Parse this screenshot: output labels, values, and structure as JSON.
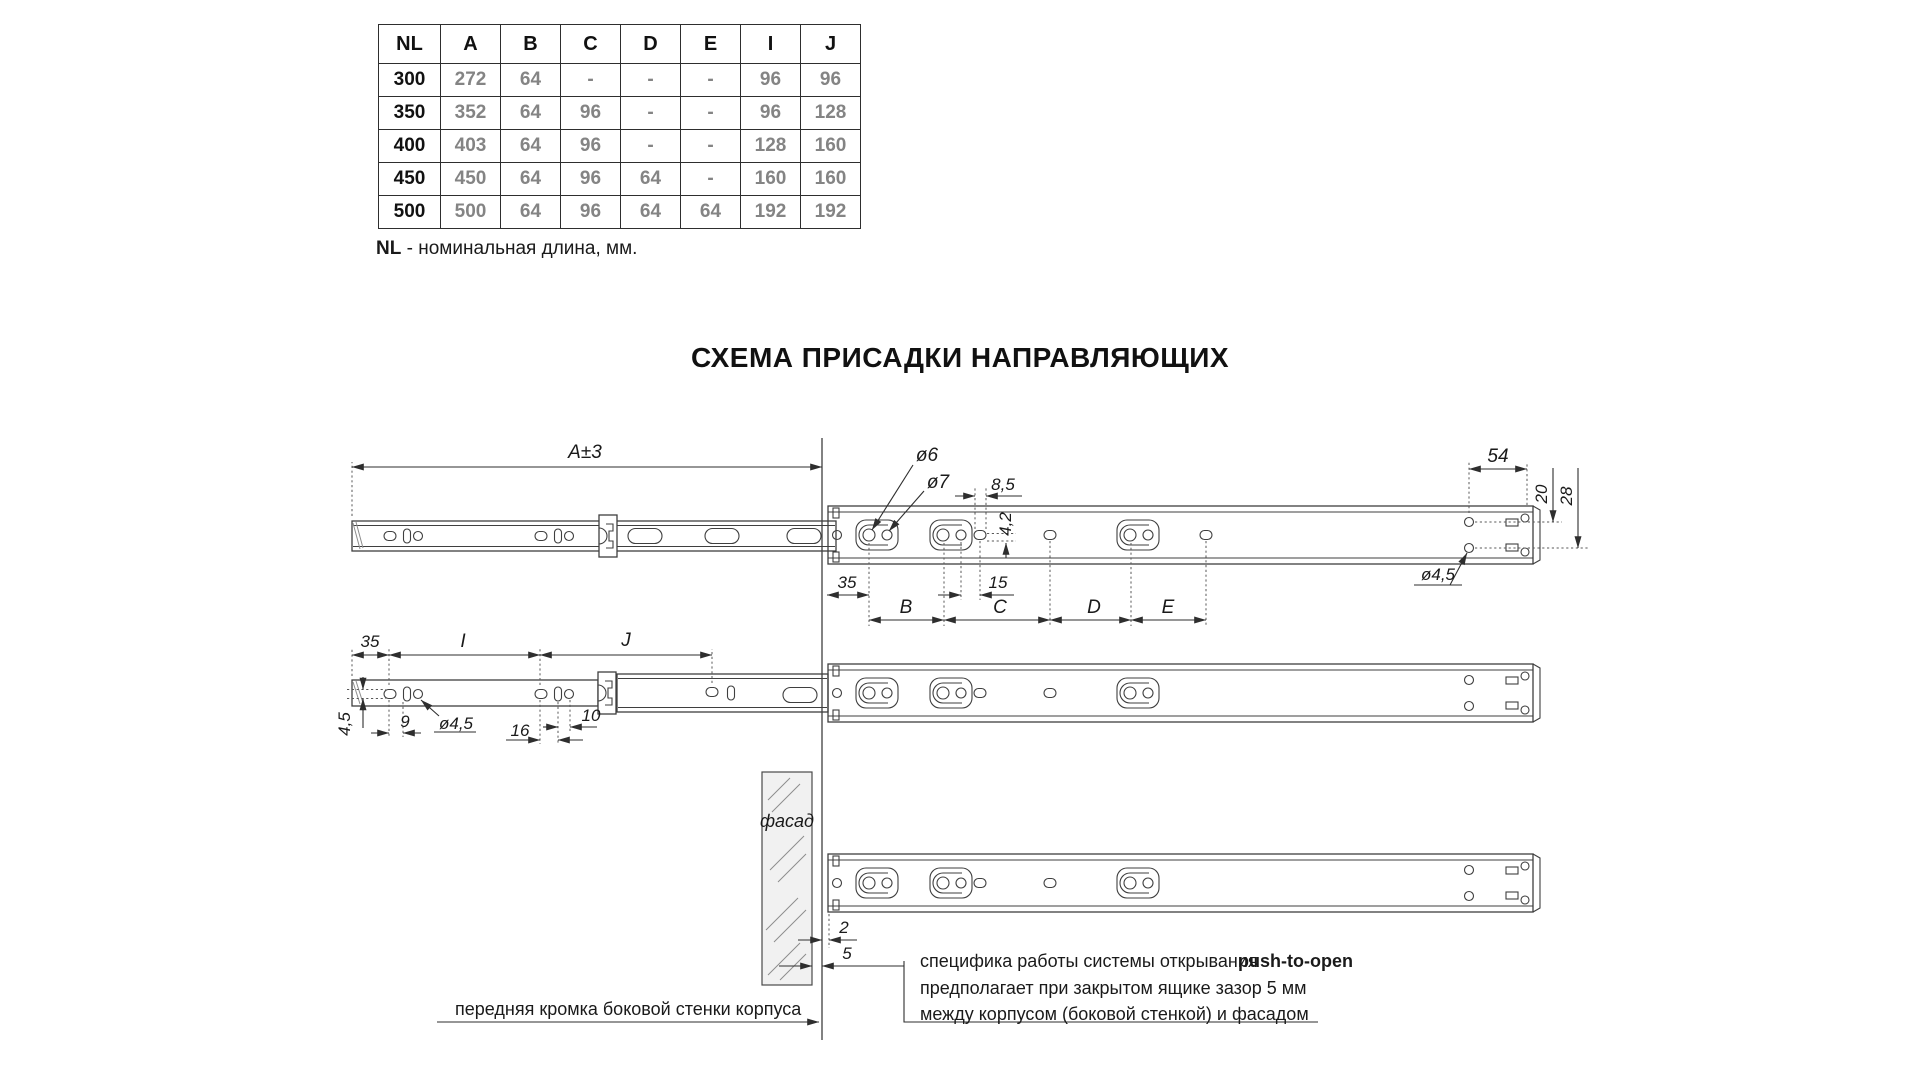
{
  "table": {
    "headers": [
      "NL",
      "A",
      "B",
      "C",
      "D",
      "E",
      "I",
      "J"
    ],
    "rows": [
      [
        "300",
        "272",
        "64",
        "-",
        "-",
        "-",
        "96",
        "96"
      ],
      [
        "350",
        "352",
        "64",
        "96",
        "-",
        "-",
        "96",
        "128"
      ],
      [
        "400",
        "403",
        "64",
        "96",
        "-",
        "-",
        "128",
        "160"
      ],
      [
        "450",
        "450",
        "64",
        "96",
        "64",
        "-",
        "160",
        "160"
      ],
      [
        "500",
        "500",
        "64",
        "96",
        "64",
        "64",
        "192",
        "192"
      ]
    ],
    "note_bold": "NL",
    "note_rest": " - номинальная длина, мм."
  },
  "title": "СХЕМА ПРИСАДКИ НАПРАВЛЯЮЩИХ",
  "dims": {
    "a3": "A±3",
    "d6": "ø6",
    "d7": "ø7",
    "d85": "8,5",
    "d42": "4,2",
    "d54": "54",
    "d20": "20",
    "d28": "28",
    "d45_top": "ø4,5",
    "d35_top": "35",
    "d15": "15",
    "b": "B",
    "c": "C",
    "d": "D",
    "e": "E",
    "d35_mid": "35",
    "i": "I",
    "j": "J",
    "d45_rot": "4,5",
    "d9": "9",
    "d45_mid": "ø4,5",
    "d16": "16",
    "d10": "10",
    "d2": "2",
    "d5": "5"
  },
  "labels": {
    "facade": "фасад",
    "front_edge": "передняя кромка боковой стенки корпуса",
    "note_line1_prefix": "специфика работы системы открывания ",
    "note_line1_bold": "push-to-open",
    "note_line2": "предполагает при закрытом ящике зазор 5 мм",
    "note_line3": "между корпусом (боковой стенкой) и фасадом"
  },
  "colors": {
    "line": "#3f3f3f",
    "data_gray": "#848484",
    "text": "#1a1a1a"
  }
}
